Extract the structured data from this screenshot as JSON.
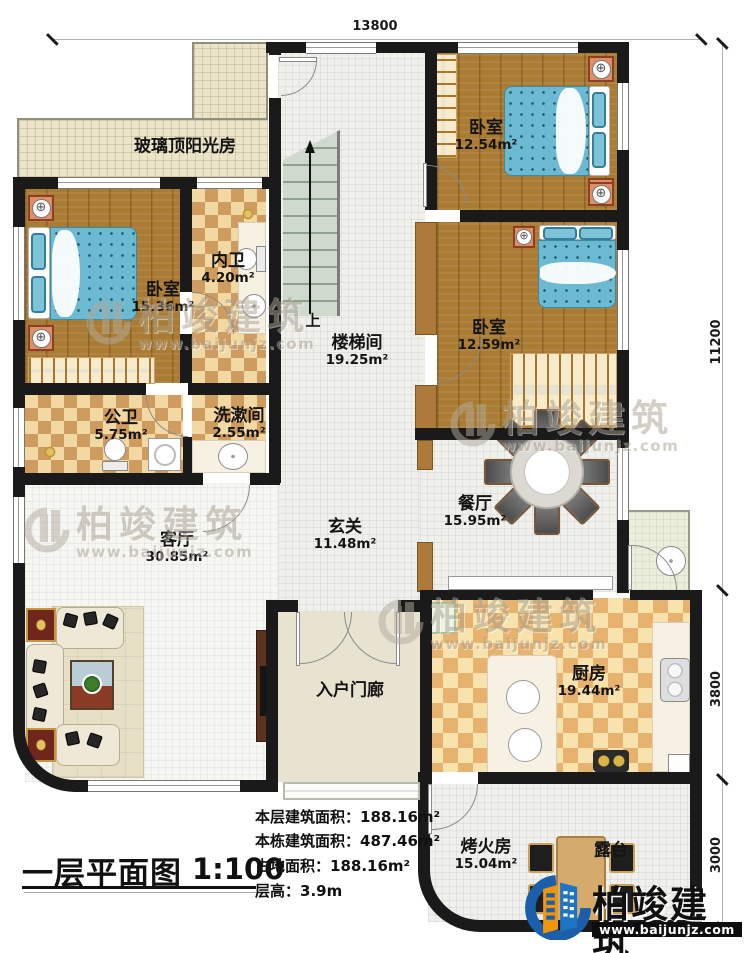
{
  "dimensions": {
    "top": "13800",
    "right_top": "11200",
    "right_middle": "3800",
    "right_bottom": "3000"
  },
  "rooms": {
    "sunroom": {
      "name": "玻璃顶阳光房"
    },
    "bedroom1": {
      "name": "卧室",
      "area": "15.36m²"
    },
    "ensuite": {
      "name": "内卫",
      "area": "4.20m²"
    },
    "stairwell": {
      "name": "楼梯间",
      "area": "19.25m²",
      "direction": "上"
    },
    "bedroom2": {
      "name": "卧室",
      "area": "12.54m²"
    },
    "bedroom3": {
      "name": "卧室",
      "area": "12.59m²"
    },
    "public_bath": {
      "name": "公卫",
      "area": "5.75m²"
    },
    "washroom": {
      "name": "洗漱间",
      "area": "2.55m²"
    },
    "living_room": {
      "name": "客厅",
      "area": "30.85m²"
    },
    "foyer": {
      "name": "玄关",
      "area": "11.48m²"
    },
    "dining_room": {
      "name": "餐厅",
      "area": "15.95m²"
    },
    "kitchen": {
      "name": "厨房",
      "area": "19.44m²"
    },
    "entry_porch": {
      "name": "入户门廊"
    },
    "fire_room": {
      "name": "烤火房",
      "area": "15.04m²"
    },
    "terrace": {
      "name": "露台"
    }
  },
  "title_block": {
    "title": "一层平面图",
    "scale": "1:100",
    "info": [
      {
        "label": "本层建筑面积：",
        "value": "188.16m²"
      },
      {
        "label": "本栋建筑面积：",
        "value": "487.46m²"
      },
      {
        "label": "占地面积：",
        "value": "188.16m²"
      },
      {
        "label": "层高：",
        "value": "3.9m"
      }
    ]
  },
  "watermark": {
    "brand": "柏竣建筑",
    "url": "www.baijunjz.com"
  },
  "logo": {
    "brand": "柏竣建筑",
    "url": "www.baijunjz.com"
  },
  "icons": {
    "lamp": "⊕"
  },
  "colors": {
    "wall": "#1a1a1a",
    "wood_floor": "#a97b33",
    "tile_light": "#f2d9a4",
    "tile_dark": "#cf9c60",
    "bed_blue": "#6cb9d2",
    "brand_blue": "#1b5faa",
    "logo_orange": "#f0950c"
  }
}
